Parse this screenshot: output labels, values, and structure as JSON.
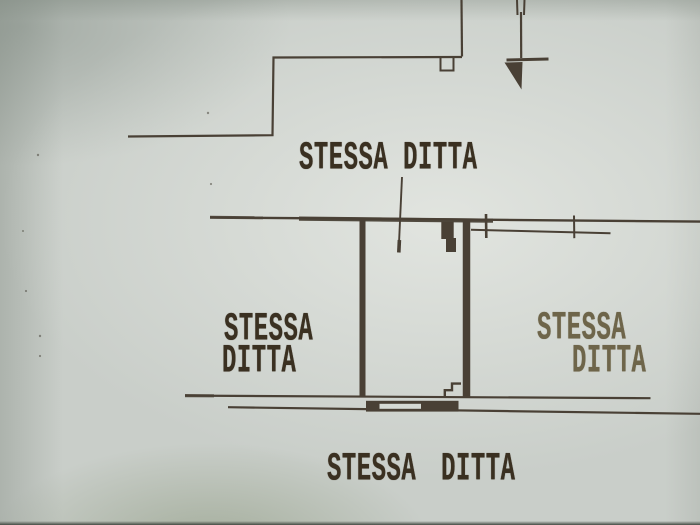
{
  "labels": {
    "top": "STESSA DITTA",
    "left_line1": "STESSA",
    "left_line2": "DITTA",
    "right_line1": "STESSA",
    "right_line2": "DITTA",
    "bottom": "STESSA DITTA"
  },
  "colors": {
    "paper": "#c9cec9",
    "paper-light": "#d6dad5",
    "ink": "#4a4136",
    "text-dark": "#3a3021",
    "text-faded": "#6e654a",
    "edge-dark": "#454c44"
  }
}
